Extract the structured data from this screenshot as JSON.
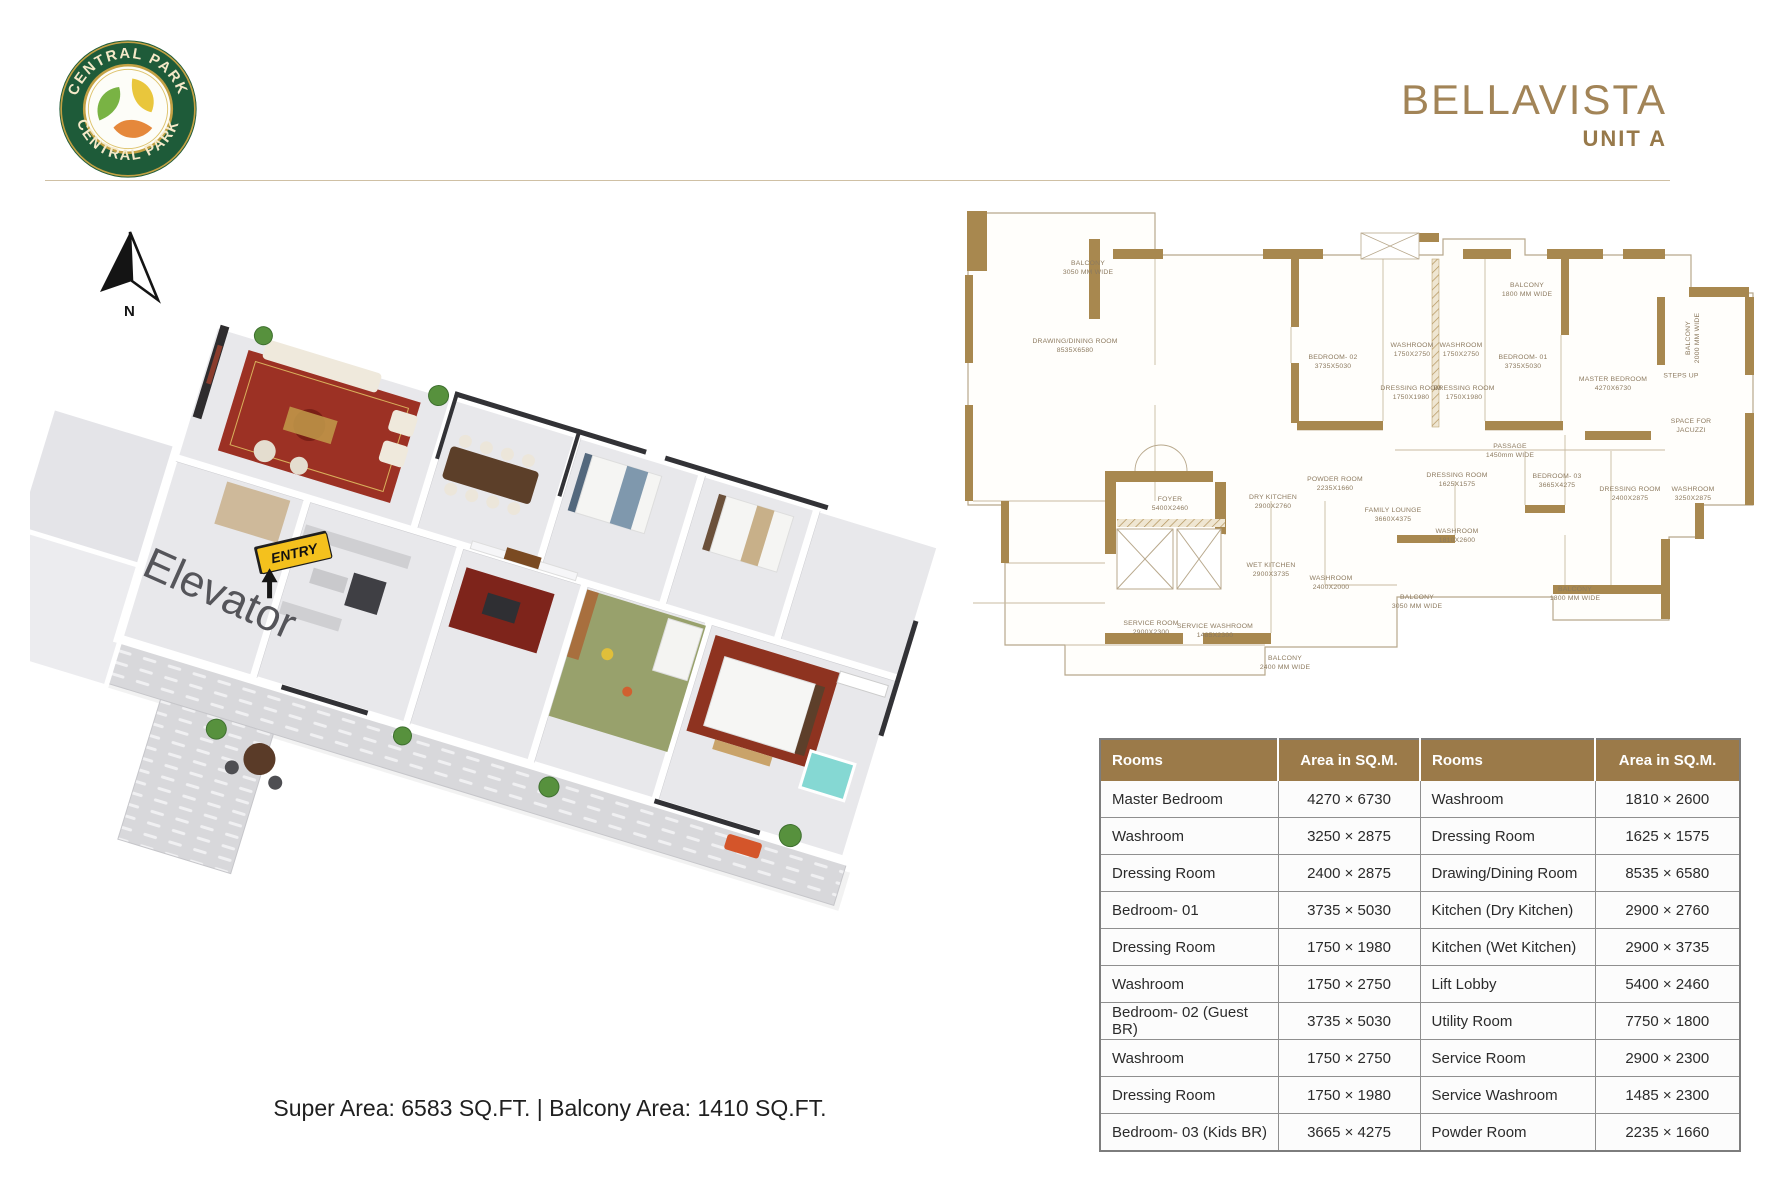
{
  "header": {
    "logo_text_top": "CENTRAL PARK",
    "logo_text_bottom": "CENTRAL PARK",
    "title": "BELLAVISTA",
    "subtitle": "UNIT A"
  },
  "compass": {
    "label": "N"
  },
  "plan3d": {
    "elevator_label": "Elevator",
    "entry_label": "ENTRY"
  },
  "plan2d": {
    "labels": [
      {
        "t": "BALCONY",
        "s": "3050 MM WIDE",
        "x": 123,
        "y": 64
      },
      {
        "t": "BALCONY",
        "s": "1800 MM WIDE",
        "x": 562,
        "y": 86
      },
      {
        "t": "BALCONY",
        "s": "2000 MM WIDE",
        "x": 729,
        "y": 133,
        "r": -90
      },
      {
        "t": "DRAWING/DINING ROOM",
        "s": "8535X6580",
        "x": 110,
        "y": 142
      },
      {
        "t": "BEDROOM- 02",
        "s": "3735X5030",
        "x": 368,
        "y": 158
      },
      {
        "t": "WASHROOM",
        "s": "1750X2750",
        "x": 447,
        "y": 146
      },
      {
        "t": "WASHROOM",
        "s": "1750X2750",
        "x": 496,
        "y": 146
      },
      {
        "t": "DRESSING ROOM",
        "s": "1750X1980",
        "x": 446,
        "y": 189
      },
      {
        "t": "DRESSING ROOM",
        "s": "1750X1980",
        "x": 499,
        "y": 189
      },
      {
        "t": "BEDROOM- 01",
        "s": "3735X5030",
        "x": 558,
        "y": 158
      },
      {
        "t": "MASTER BEDROOM",
        "s": "4270X6730",
        "x": 648,
        "y": 180
      },
      {
        "t": "STEPS UP",
        "s": "",
        "x": 716,
        "y": 172
      },
      {
        "t": "SPACE FOR",
        "s": "JACUZZI",
        "x": 726,
        "y": 222
      },
      {
        "t": "PASSAGE",
        "s": "1450mm WIDE",
        "x": 545,
        "y": 247
      },
      {
        "t": "FOYER",
        "s": "5400X2460",
        "x": 205,
        "y": 300
      },
      {
        "t": "DRY KITCHEN",
        "s": "2900X2760",
        "x": 308,
        "y": 298
      },
      {
        "t": "POWDER ROOM",
        "s": "2235X1660",
        "x": 370,
        "y": 280
      },
      {
        "t": "FAMILY LOUNGE",
        "s": "3660X4375",
        "x": 428,
        "y": 311
      },
      {
        "t": "DRESSING ROOM",
        "s": "1625X1575",
        "x": 492,
        "y": 276
      },
      {
        "t": "WASHROOM",
        "s": "1810X2600",
        "x": 492,
        "y": 332
      },
      {
        "t": "BEDROOM- 03",
        "s": "3665X4275",
        "x": 592,
        "y": 277
      },
      {
        "t": "DRESSING ROOM",
        "s": "2400X2875",
        "x": 665,
        "y": 290
      },
      {
        "t": "WASHROOM",
        "s": "3250X2875",
        "x": 728,
        "y": 290
      },
      {
        "t": "WET KITCHEN",
        "s": "2900X3735",
        "x": 306,
        "y": 366
      },
      {
        "t": "WASHROOM",
        "s": "2400X2000",
        "x": 366,
        "y": 379
      },
      {
        "t": "BALCONY",
        "s": "3050 MM WIDE",
        "x": 452,
        "y": 398
      },
      {
        "t": "BALCONY",
        "s": "1800 MM WIDE",
        "x": 610,
        "y": 390
      },
      {
        "t": "SERVICE ROOM",
        "s": "2900X2300",
        "x": 186,
        "y": 424
      },
      {
        "t": "SERVICE WASHROOM",
        "s": "1485X2300",
        "x": 250,
        "y": 427
      },
      {
        "t": "BALCONY",
        "s": "2400 MM WIDE",
        "x": 320,
        "y": 459
      }
    ]
  },
  "footer": {
    "area_text": "Super Area: 6583 SQ.FT. | Balcony Area: 1410 SQ.FT."
  },
  "table": {
    "headers": [
      "Rooms",
      "Area in SQ.M.",
      "Rooms",
      "Area in SQ.M."
    ],
    "rows": [
      [
        "Master Bedroom",
        "4270 × 6730",
        "Washroom",
        "1810 × 2600"
      ],
      [
        "Washroom",
        "3250 × 2875",
        "Dressing Room",
        "1625 × 1575"
      ],
      [
        "Dressing Room",
        "2400 × 2875",
        "Drawing/Dining Room",
        "8535 × 6580"
      ],
      [
        "Bedroom- 01",
        "3735 × 5030",
        "Kitchen (Dry Kitchen)",
        "2900 × 2760"
      ],
      [
        "Dressing Room",
        "1750 × 1980",
        "Kitchen (Wet Kitchen)",
        "2900 × 3735"
      ],
      [
        "Washroom",
        "1750 × 2750",
        "Lift Lobby",
        "5400 × 2460"
      ],
      [
        "Bedroom- 02 (Guest BR)",
        "3735 × 5030",
        "Utility Room",
        "7750 × 1800"
      ],
      [
        "Washroom",
        "1750 × 2750",
        "Service Room",
        "2900 × 2300"
      ],
      [
        "Dressing Room",
        "1750 × 1980",
        "Service Washroom",
        "1485 × 2300"
      ],
      [
        "Bedroom- 03 (Kids BR)",
        "3665 × 4275",
        "Powder Room",
        "2235 × 1660"
      ]
    ]
  },
  "colors": {
    "brand_gold": "#a28457",
    "table_header_brown": "#9b7a49",
    "plan_wall_brown": "#a8884f",
    "entry_yellow": "#f4c11d",
    "logo_green": "#1e5b39"
  }
}
